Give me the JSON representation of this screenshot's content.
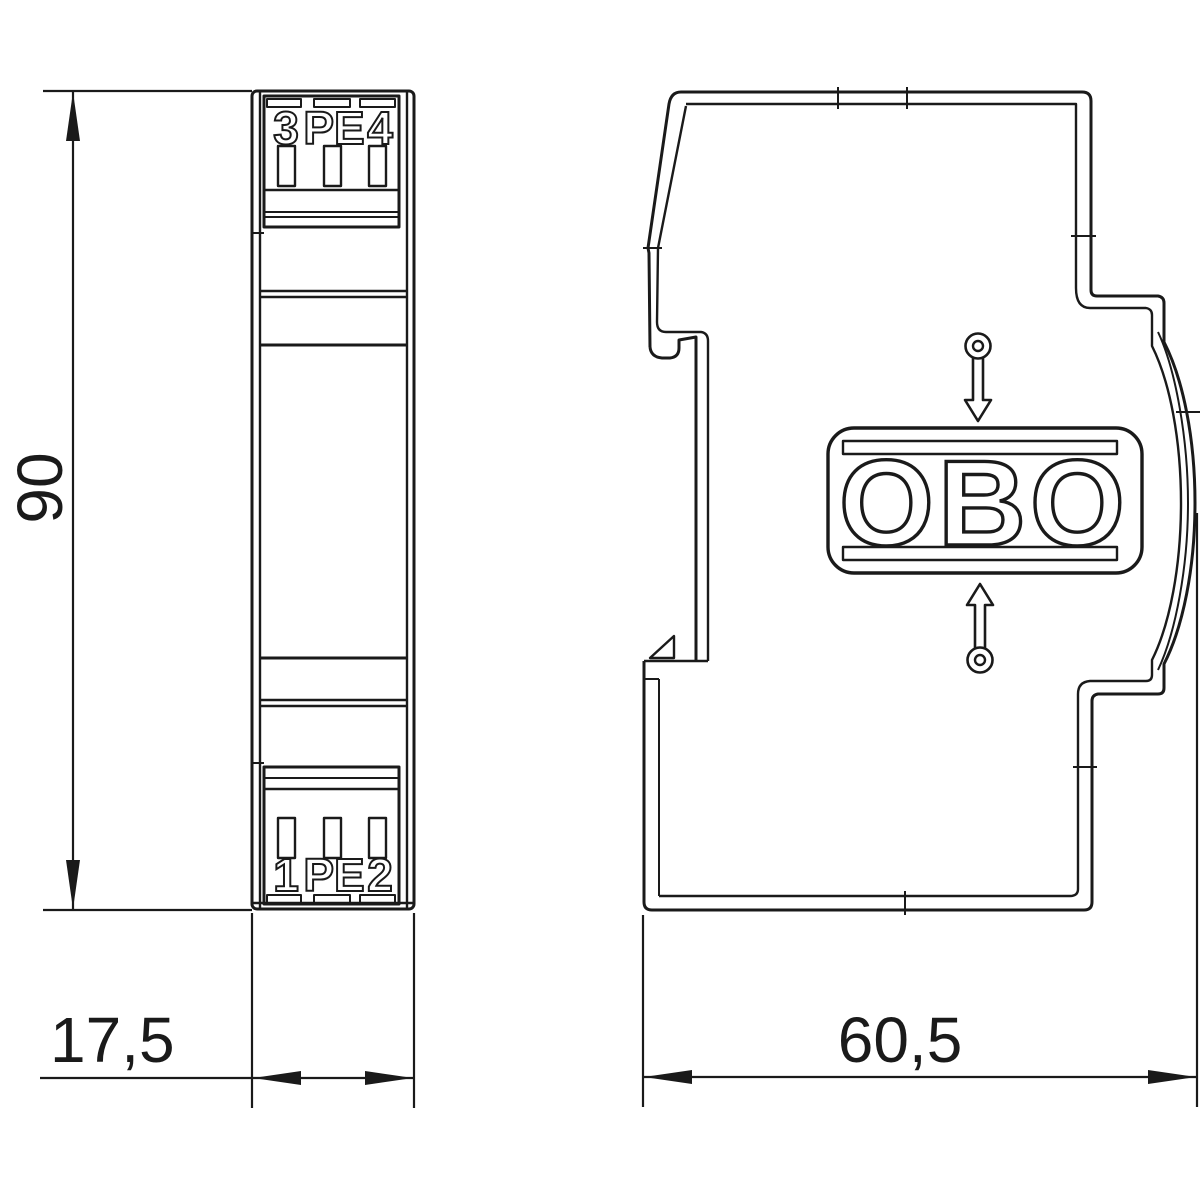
{
  "title": "DIN-rail device dimension drawing",
  "views": {
    "front": {
      "terminals_top": {
        "t1": "3",
        "t2": "PE",
        "t3": "4"
      },
      "terminals_bottom": {
        "t1": "1",
        "t2": "PE",
        "t3": "2"
      }
    },
    "side": {
      "logo_text": "OBO"
    }
  },
  "dimensions": {
    "height_mm": "90",
    "width_mm": "17,5",
    "depth_mm": "60,5"
  },
  "colors": {
    "line": "#1a1a1a",
    "background": "#ffffff"
  }
}
